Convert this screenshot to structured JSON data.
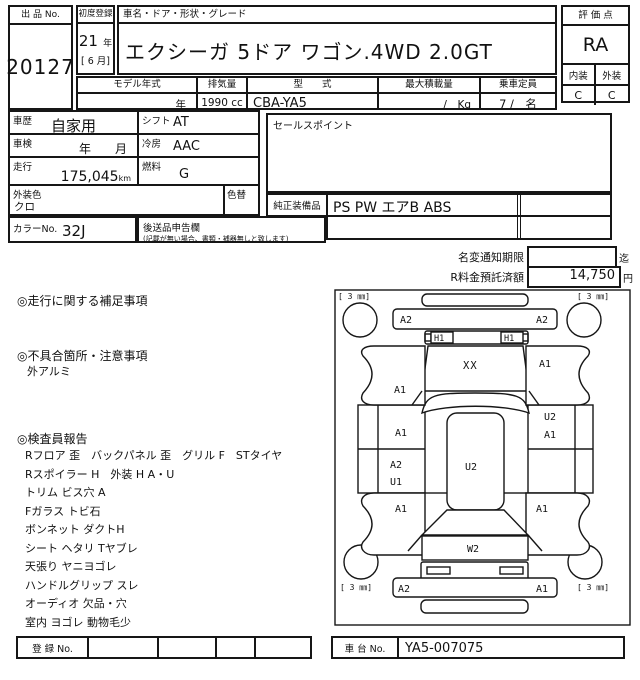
{
  "header": {
    "lot_label": "出 品 No.",
    "lot_no": "20127",
    "first_reg_label": "初度登録",
    "first_reg_year": "21",
    "first_reg_year_unit": "年",
    "first_reg_month": "[ 6 月]",
    "name_label": "車名・ドア・形状・グレード",
    "car_name": "エクシーガ 5ドア ワゴン.4WD 2.0GT",
    "model_year_label": "モデル年式",
    "model_year_value": "年",
    "displacement_label": "排気量",
    "displacement_value": "1990 cc",
    "model_code_label": "型　　式",
    "model_code_value": "CBA-YA5",
    "max_load_label": "最大積載量",
    "max_load_value": "/　Kg",
    "capacity_label": "乗車定員",
    "capacity_value": "7 /　名",
    "score_label": "評 価 点",
    "score": "RA",
    "interior_label": "内装",
    "exterior_label": "外装",
    "interior_grade": "C",
    "exterior_grade": "C"
  },
  "info": {
    "history_label": "車歴",
    "history": "自家用",
    "shift_label": "シフト",
    "shift": "AT",
    "inspection_label": "車検",
    "inspection": "年　　月",
    "ac_label": "冷房",
    "ac": "AAC",
    "mileage_label": "走行",
    "mileage": "175,045",
    "mileage_unit": "km",
    "fuel_label": "燃料",
    "fuel": "G",
    "body_color_label": "外装色",
    "body_color": "クロ",
    "color_change_label": "色替",
    "color_no_label": "カラーNo.",
    "color_no": "32J",
    "late_items_label": "後送品申告欄",
    "late_items_note": "(記載が無い場合、書類・補器無しと致します)",
    "sales_point_label": "セールスポイント",
    "equipment_label": "純正装備品",
    "equipment": "PS PW エアB ABS"
  },
  "recycle": {
    "name_change_label": "名変通知期限",
    "name_change_value": "",
    "name_change_suffix": "迄",
    "deposit_label": "R料金預託済額",
    "deposit_value": "14,750",
    "deposit_unit": "円"
  },
  "notes": {
    "mileage_note_title": "◎走行に関する補足事項",
    "defect_title": "◎不具合箇所・注意事項",
    "defect_item": "外アルミ",
    "inspector_title": "◎検査員報告",
    "inspector_items": [
      "Rフロア 歪　バックパネル 歪　グリル F　STタイヤ",
      "Rスポイラー H　外装 H A・U",
      "トリム ビス穴 A",
      "Fガラス トビ石",
      "ボンネット ダクトH",
      "シート ヘタリ Tヤブレ",
      "天張り ヤニヨゴレ",
      "ハンドルグリップ スレ",
      "オーディオ 欠品・穴",
      "室内 ヨゴレ 動物毛少"
    ]
  },
  "diagram": {
    "tread_tl": "[ 3 ㎜]",
    "tread_tr": "[ 3 ㎜]",
    "tread_bl": "[ 3 ㎜]",
    "tread_br": "[ 3 ㎜]",
    "front_bumper_left": "A2",
    "front_bumper_right": "A2",
    "headlight_left": "H1",
    "headlight_right": "H1",
    "hood": "XX",
    "front_fender_left": "A1",
    "front_fender_right": "A1",
    "front_door_left": "A1",
    "front_door_right_top": "U2",
    "front_door_right_bottom": "A1",
    "rear_door_left_top": "A2",
    "rear_door_left_bottom": "U1",
    "roof": "U2",
    "rear_fender_left": "A1",
    "rear_fender_right": "A1",
    "tailgate": "W2",
    "rear_bumper_left": "A2",
    "rear_bumper_right": "A1"
  },
  "footer": {
    "reg_label": "登 録 No.",
    "chassis_label": "車 台 No.",
    "chassis_no": "YA5-007075"
  }
}
